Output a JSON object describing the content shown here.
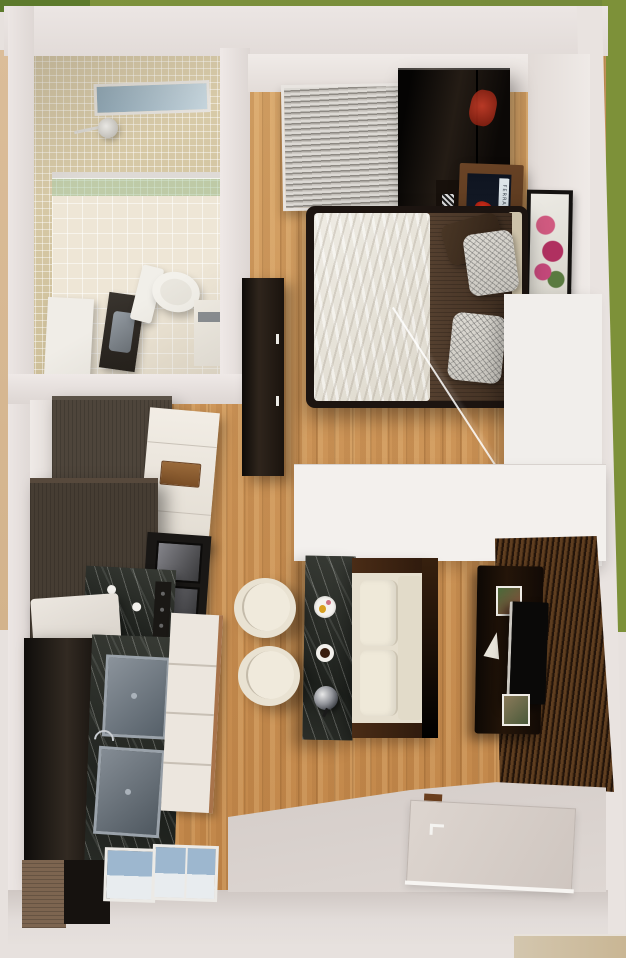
{
  "scene": {
    "title": "Top-down 3D render of a studio apartment floor plan",
    "view": "bird's-eye 3D architectural render",
    "setting": "white-walled unit surrounded by green grass"
  },
  "rooms": {
    "bathroom": {
      "name": "Bathroom",
      "features": [
        "beige mosaic tile walls",
        "small window",
        "shower head",
        "green glass shower screen",
        "white tile floor",
        "toilet",
        "dark vanity with grey sink",
        "white cabinet",
        "towel niche"
      ]
    },
    "bedroom": {
      "name": "Bedroom",
      "features": [
        "slatted window blinds",
        "black glossy wardrobe",
        "double bed with white duvet and brown runner",
        "brown pillow",
        "two marble-pattern pillows",
        "nightstand desk with Ferrari artwork",
        "checkered shelf unit",
        "framed flower art on wall",
        "dark dresser",
        "glass foot-of-bed screen",
        "white partition wall"
      ]
    },
    "kitchen": {
      "name": "Kitchen",
      "features": [
        "tall grey-brown cabinets",
        "white refrigerator with wood handle",
        "black double wall oven",
        "black marble cooktop with two burners",
        "white prep counter",
        "black marble sink run with two grey basins",
        "chrome faucet",
        "white drawer unit",
        "wood base cabinet"
      ]
    },
    "living": {
      "name": "Living area",
      "features": [
        "black marble breakfast bar",
        "two cream stools",
        "cream loveseat with dark wood frame",
        "dark wood slat TV wall",
        "media console",
        "wall TV",
        "two small art frames",
        "white sail decor"
      ]
    },
    "entry": {
      "name": "Entry",
      "features": [
        "concrete floor pad",
        "front door with handle",
        "door stop",
        "two windows in south wall",
        "porch step"
      ]
    }
  },
  "artwork": {
    "ferrari_poster_text": "FERRARI",
    "ferrari_poster": "red sports car artwork on nightstand",
    "flower_art": "pink flowers in a black frame"
  },
  "counter_items": [
    "breakfast plate",
    "coffee cup",
    "chrome kettle"
  ],
  "palette": {
    "grass": "#7d9139",
    "grass_dark": "#5d7a2c",
    "exterior_wall": "#e8e2df",
    "wood_floor": "#cf9b60",
    "bath_tile": "#d7c9a6",
    "shower_glass": "#a8ceaa",
    "dark_marble": "#2b2e29",
    "wardrobe_black": "#0b0806",
    "cabinet_grey_brown": "#4e453b",
    "sofa_cream": "#e9e2d2",
    "tv_wall_slat": "#5f3e20",
    "bed_blanket_brown": "#4b3727",
    "duvet_white": "#e9e5dc",
    "concrete": "#d3cbc7"
  }
}
